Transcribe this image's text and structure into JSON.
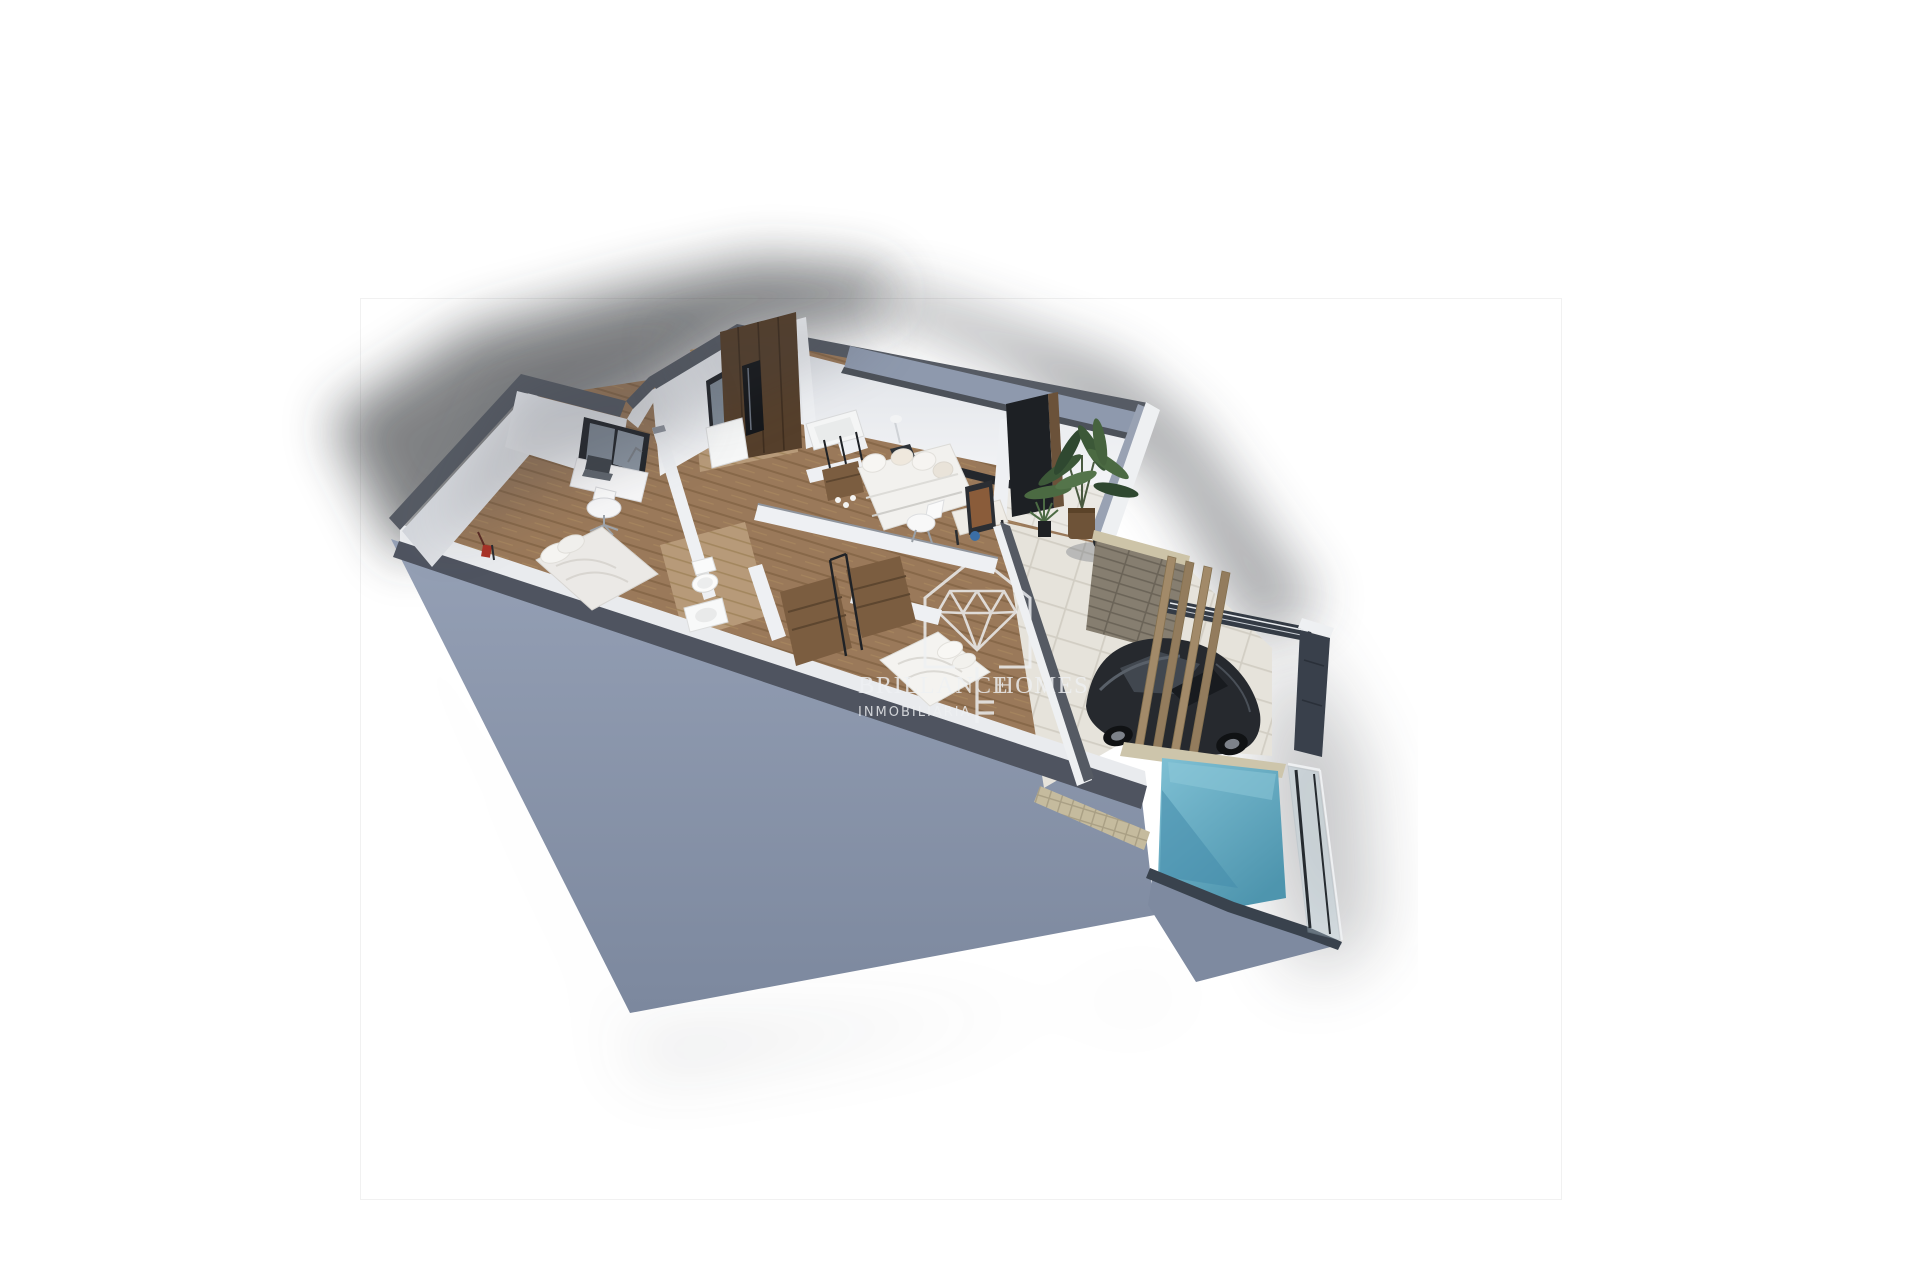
{
  "watermark": {
    "brand_word_1": "BRILLANCE",
    "brand_word_2": "HOMES",
    "subtitle": "INMOBILIARIA",
    "logo_icon": "house-diamond-key-logo",
    "logo_parts": [
      "house-outline-icon",
      "diamond-gem-icon",
      "key-icon"
    ],
    "color": "#eff1f3"
  },
  "palette": {
    "background": "#ffffff",
    "photo_border": "#f1f1f1",
    "outer_wall_face": "#8b96ab",
    "outer_wall_face_dark": "#7c889e",
    "wall_top_dark": "#545962",
    "wall_top_darker": "#4c5159",
    "interior_wall_white": "#f1f2f4",
    "interior_wall_shaded": "#d9dce1",
    "wood_floor": "#9a795a",
    "wood_floor_light": "#b79a79",
    "dark_wood_wardrobe": "#553f2b",
    "closet_wood": "#7b5d40",
    "terrace_tile": "#ebe9e4",
    "paver": "#e6e3db",
    "mosaic_stone": "#c5bb9e",
    "pool_coping": "#cdc5ab",
    "brick_wall": "#867e70",
    "pergola_wood": "#a28a69",
    "car_body": "#26292e",
    "fence_dark": "#39404b",
    "pool_water": "#67aec6",
    "pool_water_dark": "#468cab",
    "plant_green": "#3c5838",
    "soft_shadow": "#34383e",
    "bedding_white": "#ebe9e6",
    "sofa_white": "#f2f1ee"
  }
}
